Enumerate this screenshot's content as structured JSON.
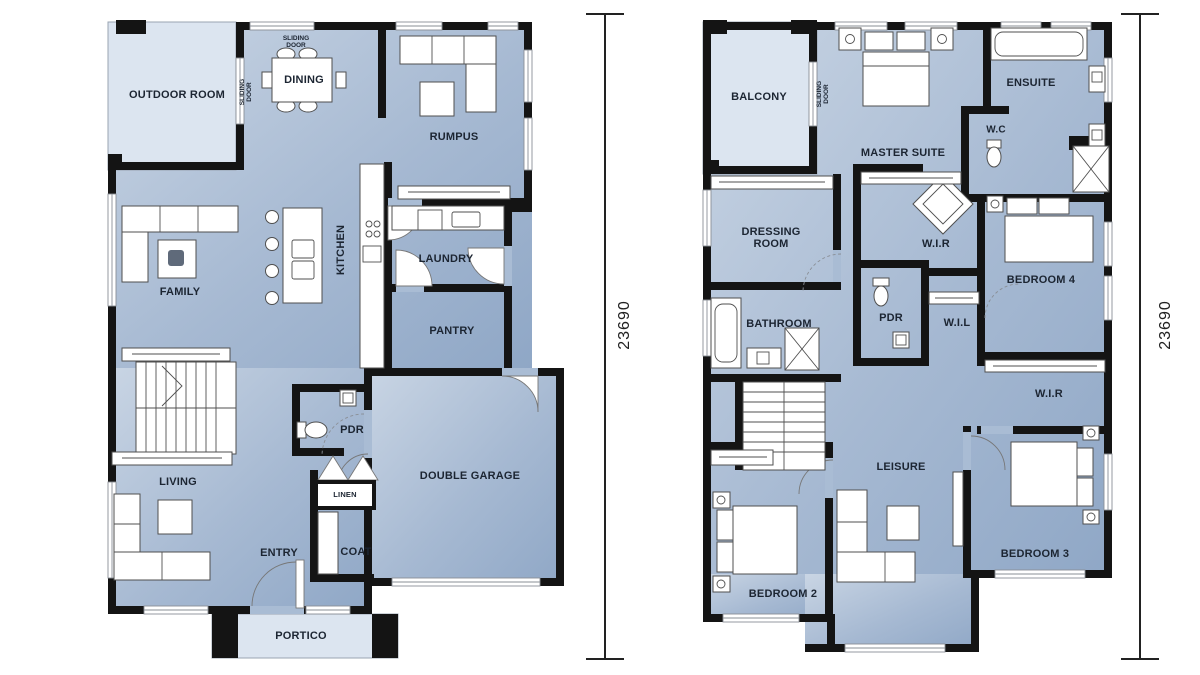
{
  "dimensions": {
    "left": "23690",
    "right": "23690"
  },
  "colors": {
    "wall": "#141414",
    "floor_light": "#dce5f0",
    "floor_gradient_start": "#c9d5e4",
    "floor_gradient_end": "#8fa7c6",
    "label_text": "#1c2532"
  },
  "ground": {
    "title": "ground-floor-plan",
    "labels": {
      "outdoor_room": "OUTDOOR ROOM",
      "sliding_door_top": "SLIDING DOOR",
      "sliding_door_side": "SLIDING DOOR",
      "dining": "DINING",
      "rumpus": "RUMPUS",
      "kitchen": "KITCHEN",
      "laundry": "LAUNDRY",
      "family": "FAMILY",
      "pantry": "PANTRY",
      "pdr": "PDR",
      "living": "LIVING",
      "double_garage": "DOUBLE GARAGE",
      "entry": "ENTRY",
      "linen": "LINEN",
      "coat": "COAT",
      "portico": "PORTICO"
    }
  },
  "first": {
    "title": "first-floor-plan",
    "labels": {
      "balcony": "BALCONY",
      "sliding_door": "SLIDING DOOR",
      "master_suite": "MASTER SUITE",
      "ensuite": "ENSUITE",
      "wc": "W.C",
      "dressing_room": "DRESSING ROOM",
      "wir_master": "W.I.R",
      "bedroom4": "BEDROOM 4",
      "bathroom": "BATHROOM",
      "pdr": "PDR",
      "wil": "W.I.L",
      "wir_bed3": "W.I.R",
      "leisure": "LEISURE",
      "bedroom2": "BEDROOM 2",
      "bedroom3": "BEDROOM 3"
    }
  }
}
